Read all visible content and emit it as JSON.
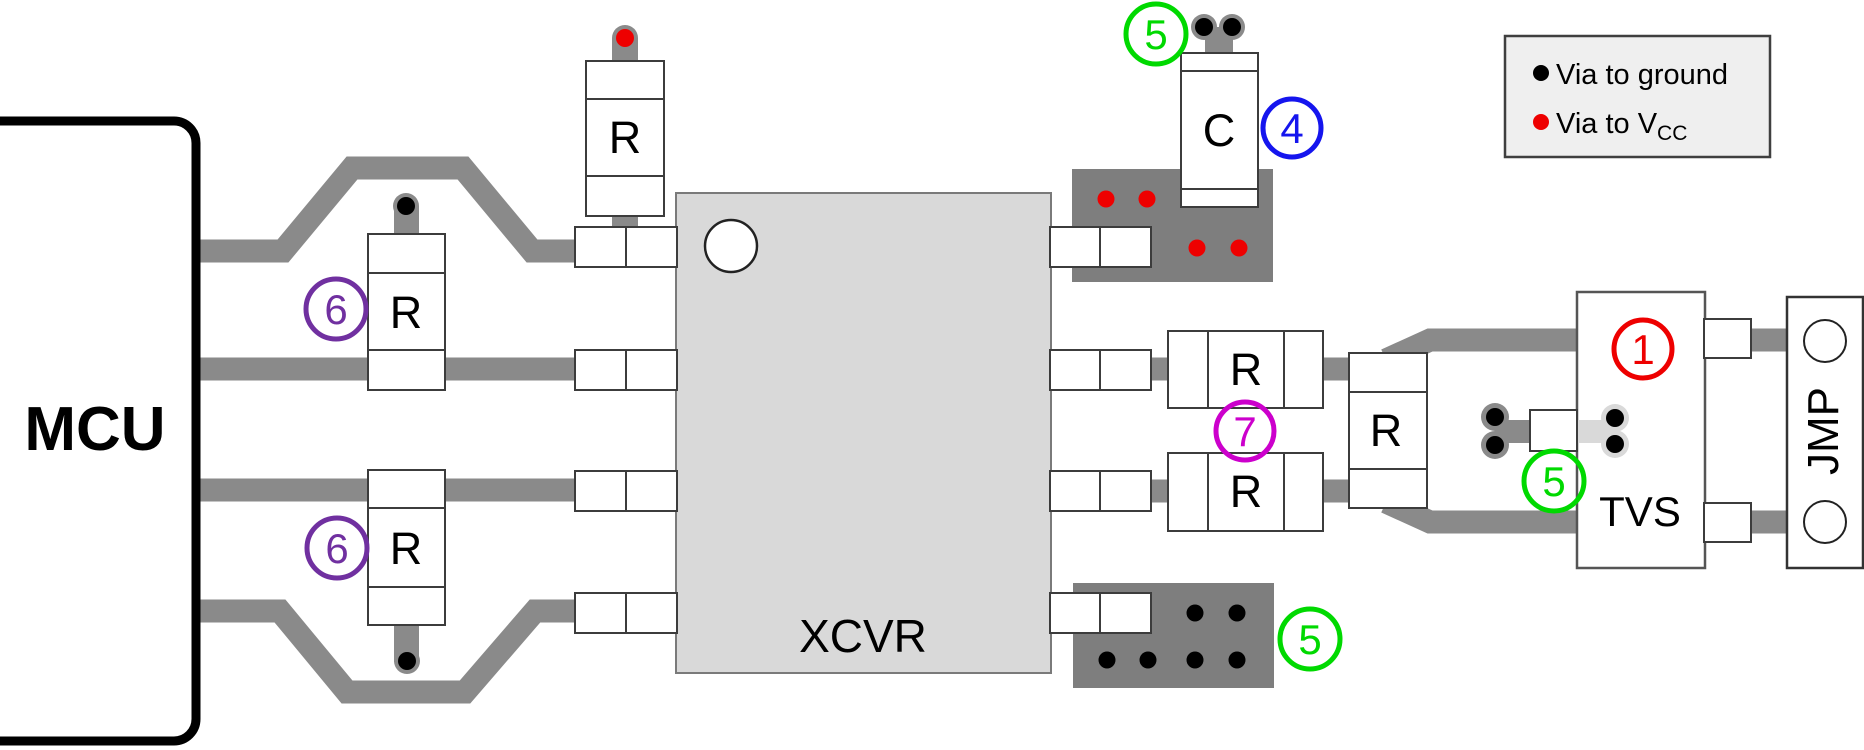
{
  "components": {
    "mcu": {
      "label": "MCU"
    },
    "xcvr": {
      "label": "XCVR"
    },
    "tvs": {
      "label": "TVS"
    },
    "jmp": {
      "label": "JMP"
    },
    "resistor_label": "R",
    "capacitor_label": "C"
  },
  "legend": {
    "items": [
      {
        "label": "Via to ground",
        "bullet_color": "#000000"
      },
      {
        "label_main": "Via to V",
        "label_sub": "CC",
        "bullet_color": "#ee0000"
      }
    ]
  },
  "callouts": {
    "c1": {
      "number": "1",
      "color": "#ee0000"
    },
    "c4": {
      "number": "4",
      "color": "#1515ee"
    },
    "c5": {
      "number": "5",
      "color": "#00d900"
    },
    "c6": {
      "number": "6",
      "color": "#7030a0"
    },
    "c7": {
      "number": "7",
      "color": "#cc00cc"
    }
  },
  "colors": {
    "trace": "#8a8a8a",
    "ground_plane": "#7e7e7e",
    "chip_fill": "#d9d9d9",
    "via_ground": "#000000",
    "via_vcc": "#ee0000"
  }
}
